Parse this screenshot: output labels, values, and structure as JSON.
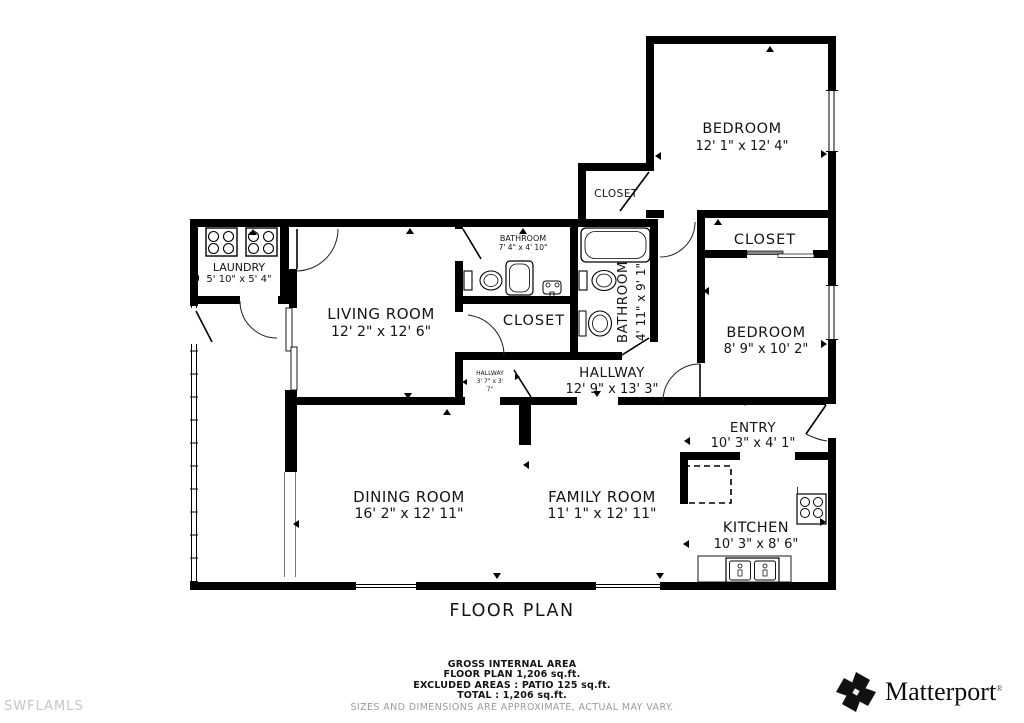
{
  "plan": {
    "title": "FLOOR PLAN",
    "rooms": {
      "bedroom1": {
        "name": "BEDROOM",
        "dims": "12' 1\" x 12' 4\""
      },
      "closet_top": {
        "name": "CLOSET"
      },
      "closet_right": {
        "name": "CLOSET"
      },
      "bedroom2": {
        "name": "BEDROOM",
        "dims": "8' 9\" x 10' 2\""
      },
      "entry": {
        "name": "ENTRY",
        "dims": "10' 3\" x 4' 1\""
      },
      "kitchen": {
        "name": "KITCHEN",
        "dims": "10' 3\" x 8' 6\""
      },
      "family_room": {
        "name": "FAMILY ROOM",
        "dims": "11' 1\" x 12' 11\""
      },
      "dining_room": {
        "name": "DINING ROOM",
        "dims": "16' 2\" x 12' 11\""
      },
      "living_room": {
        "name": "LIVING ROOM",
        "dims": "12' 2\" x 12' 6\""
      },
      "laundry": {
        "name": "LAUNDRY",
        "dims": "5' 10\" x 5' 4\""
      },
      "bathroom_small": {
        "name": "BATHROOM",
        "dims": "7' 4\" x 4' 10\""
      },
      "bathroom_main": {
        "name": "BATHROOM",
        "dims": "4' 11\" x 9' 1\""
      },
      "closet_mid": {
        "name": "CLOSET"
      },
      "hallway": {
        "name": "HALLWAY",
        "dims": "12' 9\" x 13' 3\""
      },
      "hallway_small": {
        "name": "HALLWAY",
        "dims_line1": "3' 7\" x 3'",
        "dims_line2": "7\""
      }
    }
  },
  "footer": {
    "gross_title": "GROSS INTERNAL AREA",
    "floor_plan_area": "FLOOR PLAN 1,206 sq.ft.",
    "excluded_areas": "EXCLUDED AREAS :  PATIO 125 sq.ft.",
    "total": "TOTAL :  1,206 sq.ft.",
    "disclaimer": "SIZES AND DIMENSIONS ARE APPROXIMATE, ACTUAL MAY VARY.",
    "watermark": "SWFLAMLS",
    "brand": "Matterport",
    "brand_mark": "®"
  },
  "colors": {
    "wall": "#000000",
    "text": "#141414",
    "muted": "#9a9a9a",
    "watermark": "#c6c6c6"
  }
}
